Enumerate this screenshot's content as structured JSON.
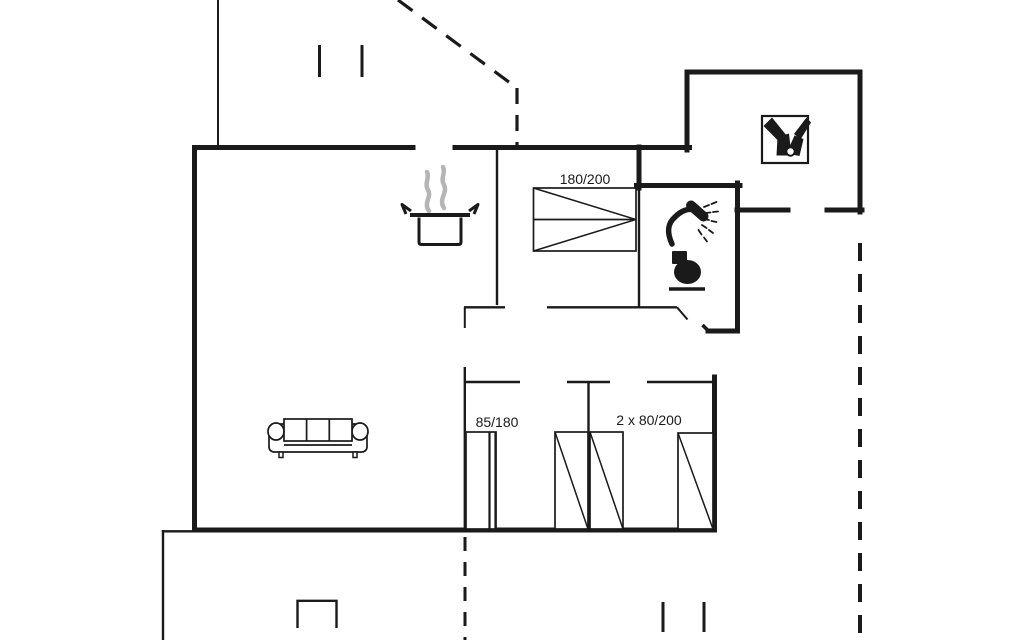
{
  "title": "Holiday home floor plan",
  "colors": {
    "line": "#1a1a1a",
    "steam": "#b5b5b5",
    "bg": "#ffffff"
  },
  "bed_labels": {
    "double": "180/200",
    "single": "85/180",
    "twin": "2 x 80/200"
  },
  "plan": {
    "width": 1024,
    "height": 640,
    "items": [
      {
        "type": "path",
        "name": "wall-west-south-east",
        "d": "M413,147.5 L194.5,147.5 L194.5,530 L714.5,530 L714.5,377",
        "w": 5,
        "cap": "square"
      },
      {
        "type": "path",
        "name": "wall-north-right",
        "d": "M455,147.5 L689.5,147.5",
        "w": 5,
        "cap": "square"
      },
      {
        "type": "path",
        "name": "annex-walls",
        "d": "M687,150 L687,72 L860,72 L860,212",
        "w": 5,
        "cap": "square"
      },
      {
        "type": "line",
        "name": "annex-south-wall-left",
        "x1": 737,
        "y1": 210,
        "x2": 788,
        "y2": 210,
        "w": 5,
        "cap": "square"
      },
      {
        "type": "line",
        "name": "annex-south-wall-right",
        "x1": 827,
        "y1": 210,
        "x2": 862,
        "y2": 210,
        "w": 5,
        "cap": "square"
      },
      {
        "type": "line",
        "name": "bathroom-north-wall",
        "x1": 636.5,
        "y1": 185.5,
        "x2": 740,
        "y2": 185.5,
        "w": 5,
        "cap": "square"
      },
      {
        "type": "line",
        "name": "bedroom-bathroom-wall-upper",
        "x1": 639,
        "y1": 147,
        "x2": 639,
        "y2": 188,
        "w": 5,
        "cap": "square"
      },
      {
        "type": "path",
        "name": "bathroom-east-wall-jog",
        "d": "M737.5,183 L737.5,331 L708,331",
        "w": 5,
        "cap": "square"
      },
      {
        "type": "line",
        "name": "bathroom-door-tick",
        "x1": 708,
        "y1": 330.5,
        "x2": 702.5,
        "y2": 325,
        "w": 3.5
      },
      {
        "type": "line",
        "name": "kitchen-bedroom-wall",
        "x1": 497,
        "y1": 150,
        "x2": 497,
        "y2": 305,
        "w": 2.4
      },
      {
        "type": "line",
        "name": "bathroom-west-wall-lower",
        "x1": 639,
        "y1": 188,
        "x2": 639,
        "y2": 307,
        "w": 2.4
      },
      {
        "type": "line",
        "name": "hall-north-wall-left",
        "x1": 464,
        "y1": 307.3,
        "x2": 505,
        "y2": 307.3,
        "w": 2.4
      },
      {
        "type": "line",
        "name": "hall-north-wall-right",
        "x1": 547,
        "y1": 307.3,
        "x2": 640,
        "y2": 307.3,
        "w": 2.4
      },
      {
        "type": "line",
        "name": "bedroom-door-leaf",
        "x1": 464.8,
        "y1": 307,
        "x2": 464.8,
        "y2": 328,
        "w": 2
      },
      {
        "type": "line",
        "name": "bathroom-south-wall",
        "x1": 640,
        "y1": 307.3,
        "x2": 677,
        "y2": 307.3,
        "w": 2.4
      },
      {
        "type": "line",
        "name": "bathroom-door-leaf",
        "x1": 677,
        "y1": 307.3,
        "x2": 687.5,
        "y2": 319.5,
        "w": 2
      },
      {
        "type": "line",
        "name": "hall-south-wall-left",
        "x1": 466,
        "y1": 382,
        "x2": 520,
        "y2": 382,
        "w": 2.4
      },
      {
        "type": "line",
        "name": "hall-south-wall-mid",
        "x1": 567,
        "y1": 382,
        "x2": 610,
        "y2": 382,
        "w": 2.4
      },
      {
        "type": "line",
        "name": "hall-south-wall-right",
        "x1": 647,
        "y1": 382,
        "x2": 714,
        "y2": 382,
        "w": 2.4
      },
      {
        "type": "line",
        "name": "small-rooms-partition",
        "x1": 588.5,
        "y1": 382,
        "x2": 588.5,
        "y2": 530,
        "w": 2.4
      },
      {
        "type": "line",
        "name": "small-room-west-wall",
        "x1": 464.8,
        "y1": 367,
        "x2": 464.8,
        "y2": 530,
        "w": 2.4
      },
      {
        "type": "line",
        "name": "terrace-west-edge",
        "x1": 163,
        "y1": 530,
        "x2": 163,
        "y2": 640,
        "w": 2.4
      },
      {
        "type": "line",
        "name": "terrace-north-edge",
        "x1": 161.8,
        "y1": 531.3,
        "x2": 194,
        "y2": 531.3,
        "w": 2.4
      },
      {
        "type": "path",
        "name": "terrace-window-mark",
        "d": "M297.5,628 L297.5,600.8 L336.5,600.8 L336.5,628",
        "w": 2.4
      },
      {
        "type": "line",
        "name": "carport-edge",
        "x1": 218,
        "y1": 0,
        "x2": 218,
        "y2": 147,
        "w": 2
      },
      {
        "type": "line",
        "name": "window-tick-top-1",
        "x1": 319.5,
        "y1": 45,
        "x2": 319.5,
        "y2": 77,
        "w": 3
      },
      {
        "type": "line",
        "name": "window-tick-top-2",
        "x1": 362,
        "y1": 45,
        "x2": 362,
        "y2": 77,
        "w": 3
      },
      {
        "type": "line",
        "name": "window-tick-bottom-1",
        "x1": 663,
        "y1": 602,
        "x2": 663,
        "y2": 632,
        "w": 3
      },
      {
        "type": "line",
        "name": "window-tick-bottom-2",
        "x1": 704,
        "y1": 602,
        "x2": 704,
        "y2": 632,
        "w": 3
      },
      {
        "type": "line",
        "name": "boundary-dashed-diagonal",
        "x1": 398,
        "y1": 0,
        "x2": 517,
        "y2": 88,
        "w": 3.2,
        "dash": "18,12"
      },
      {
        "type": "line",
        "name": "boundary-dashed-vertical-top",
        "x1": 517,
        "y1": 88,
        "x2": 517,
        "y2": 146,
        "w": 3.2,
        "dash": "16,11"
      },
      {
        "type": "line",
        "name": "boundary-dashed-east",
        "x1": 860,
        "y1": 243,
        "x2": 860,
        "y2": 640,
        "w": 4,
        "dash": "18,13"
      },
      {
        "type": "line",
        "name": "boundary-dashed-south",
        "x1": 465,
        "y1": 537,
        "x2": 465,
        "y2": 640,
        "w": 3,
        "dash": "14,11"
      },
      {
        "type": "rect",
        "name": "double-bed",
        "x": 533.5,
        "y": 188,
        "width": 102.5,
        "height": 63,
        "w": 1.7,
        "fill": "white"
      },
      {
        "type": "line",
        "name": "double-bed-mid-line",
        "x1": 533.5,
        "y1": 219.5,
        "x2": 636,
        "y2": 219.5,
        "w": 1.7
      },
      {
        "type": "line",
        "name": "double-bed-diagonal-1",
        "x1": 533.5,
        "y1": 188,
        "x2": 636,
        "y2": 219.5,
        "w": 1.5
      },
      {
        "type": "line",
        "name": "double-bed-diagonal-2",
        "x1": 533.5,
        "y1": 251,
        "x2": 636,
        "y2": 219.5,
        "w": 1.5
      },
      {
        "type": "rect",
        "name": "bed-85x180",
        "x": 466,
        "y": 432,
        "width": 30,
        "height": 97,
        "w": 1.7,
        "fill": "white"
      },
      {
        "type": "line",
        "name": "bed-85x180-edge-1",
        "x1": 489.5,
        "y1": 432,
        "x2": 489.5,
        "y2": 529,
        "w": 2.2
      },
      {
        "type": "line",
        "name": "bed-85x180-edge-2",
        "x1": 495.5,
        "y1": 432,
        "x2": 495.5,
        "y2": 529,
        "w": 2.2
      },
      {
        "type": "rect",
        "name": "bed-80x200-a",
        "x": 555,
        "y": 432,
        "width": 33,
        "height": 97,
        "w": 1.7,
        "fill": "white"
      },
      {
        "type": "line",
        "name": "bed-80x200-a-diagonal",
        "x1": 555,
        "y1": 432,
        "x2": 588,
        "y2": 529,
        "w": 1.5
      },
      {
        "type": "rect",
        "name": "bed-80x200-b",
        "x": 590,
        "y": 432,
        "width": 33,
        "height": 97,
        "w": 1.7,
        "fill": "white"
      },
      {
        "type": "line",
        "name": "bed-80x200-b-diagonal",
        "x1": 590,
        "y1": 432,
        "x2": 623,
        "y2": 529,
        "w": 1.5
      },
      {
        "type": "rect",
        "name": "bed-80x200-c",
        "x": 678,
        "y": 433,
        "width": 35,
        "height": 96,
        "w": 1.7,
        "fill": "white"
      },
      {
        "type": "line",
        "name": "bed-80x200-c-diagonal",
        "x1": 678,
        "y1": 433,
        "x2": 713,
        "y2": 529,
        "w": 1.5
      },
      {
        "type": "rect",
        "name": "sofa-body",
        "x": 269,
        "y": 424,
        "width": 98,
        "height": 28,
        "rx": 5,
        "w": 1.7,
        "fill": "white"
      },
      {
        "type": "ellipse",
        "name": "sofa-arm-left",
        "cx": 276,
        "cy": 431.5,
        "rx": 8,
        "ry": 8.5,
        "w": 1.7,
        "fill": "white"
      },
      {
        "type": "ellipse",
        "name": "sofa-arm-right",
        "cx": 360,
        "cy": 431.5,
        "rx": 8,
        "ry": 8.5,
        "w": 1.7,
        "fill": "white"
      },
      {
        "type": "rect",
        "name": "sofa-backrest",
        "x": 284,
        "y": 419,
        "width": 68,
        "height": 22,
        "w": 1.7,
        "fill": "white"
      },
      {
        "type": "line",
        "name": "sofa-cushion-divider-1",
        "x1": 306.6,
        "y1": 419,
        "x2": 306.6,
        "y2": 441,
        "w": 1.7
      },
      {
        "type": "line",
        "name": "sofa-cushion-divider-2",
        "x1": 329.3,
        "y1": 419,
        "x2": 329.3,
        "y2": 441,
        "w": 1.7
      },
      {
        "type": "line",
        "name": "sofa-seat-line",
        "x1": 284,
        "y1": 445,
        "x2": 352,
        "y2": 445,
        "w": 1.7
      },
      {
        "type": "rect",
        "name": "sofa-leg-left",
        "x": 279,
        "y": 452,
        "width": 4,
        "height": 5.5,
        "w": 1.5,
        "fill": "white"
      },
      {
        "type": "rect",
        "name": "sofa-leg-right",
        "x": 353,
        "y": 452,
        "width": 4,
        "height": 5.5,
        "w": 1.5,
        "fill": "white"
      },
      {
        "type": "path",
        "name": "steam-icon-1",
        "d": "M429,211 C423,203 432,197 428,190 C424,183 430,178 427,172",
        "w": 4.5,
        "stroke": "steam",
        "cap": "round"
      },
      {
        "type": "path",
        "name": "steam-icon-2",
        "d": "M444,208 C438,199 448,193 444,185 C440,178 446,173 443,167",
        "w": 4.5,
        "stroke": "steam",
        "cap": "round"
      },
      {
        "type": "path",
        "name": "cooking-pot-icon-body",
        "d": "M419,217.5 L419,242 Q419,244.5 421.5,244.5 L458.5,244.5 Q461,244.5 461,242 L461,217.5",
        "w": 3,
        "fill": "white"
      },
      {
        "type": "line",
        "name": "cooking-pot-icon-rim",
        "x1": 410,
        "y1": 215,
        "x2": 470,
        "y2": 215,
        "w": 4
      },
      {
        "type": "path",
        "name": "cooking-pot-icon-handle-left",
        "d": "M411,211 L402,204.5 L406,214",
        "w": 3,
        "join": "round"
      },
      {
        "type": "path",
        "name": "cooking-pot-icon-handle-right",
        "d": "M469,211 L478,204.5 L474,214",
        "w": 3,
        "join": "round"
      },
      {
        "type": "path",
        "name": "shower-icon-arm",
        "d": "M672,244 C667,233 667,224 675,217 C681,211 689,207 696,211",
        "w": 5.5,
        "cap": "round"
      },
      {
        "type": "line",
        "name": "shower-icon-head",
        "x1": 691,
        "y1": 205.5,
        "x2": 703.5,
        "y2": 216.5,
        "w": 10,
        "cap": "round"
      },
      {
        "type": "line",
        "name": "shower-icon-spray-1",
        "x1": 704,
        "y1": 207,
        "x2": 709,
        "y2": 205,
        "w": 1.8,
        "cap": "round"
      },
      {
        "type": "line",
        "name": "shower-icon-spray-2",
        "x1": 711.5,
        "y1": 204,
        "x2": 716.5,
        "y2": 202,
        "w": 1.8,
        "cap": "round"
      },
      {
        "type": "line",
        "name": "shower-icon-spray-3",
        "x1": 705,
        "y1": 213,
        "x2": 710.5,
        "y2": 212.5,
        "w": 1.8,
        "cap": "round"
      },
      {
        "type": "line",
        "name": "shower-icon-spray-4",
        "x1": 713,
        "y1": 212,
        "x2": 718,
        "y2": 211.5,
        "w": 1.8,
        "cap": "round"
      },
      {
        "type": "line",
        "name": "shower-icon-spray-5",
        "x1": 704,
        "y1": 219,
        "x2": 709,
        "y2": 220,
        "w": 1.8,
        "cap": "round"
      },
      {
        "type": "line",
        "name": "shower-icon-spray-6",
        "x1": 711.5,
        "y1": 221,
        "x2": 716.5,
        "y2": 222,
        "w": 1.8,
        "cap": "round"
      },
      {
        "type": "line",
        "name": "shower-icon-spray-7",
        "x1": 702,
        "y1": 225,
        "x2": 706.5,
        "y2": 228,
        "w": 1.8,
        "cap": "round"
      },
      {
        "type": "line",
        "name": "shower-icon-spray-8",
        "x1": 709,
        "y1": 230,
        "x2": 713,
        "y2": 233,
        "w": 1.8,
        "cap": "round"
      },
      {
        "type": "line",
        "name": "shower-icon-spray-9",
        "x1": 698.5,
        "y1": 230,
        "x2": 701.5,
        "y2": 234.5,
        "w": 1.8,
        "cap": "round"
      },
      {
        "type": "line",
        "name": "shower-icon-spray-10",
        "x1": 704,
        "y1": 237.5,
        "x2": 707,
        "y2": 241.5,
        "w": 1.8,
        "cap": "round"
      },
      {
        "type": "rect",
        "name": "toilet-icon-tank",
        "x": 672,
        "y": 251,
        "width": 15,
        "height": 13,
        "rx": 1,
        "fill": "line",
        "stroke": "none"
      },
      {
        "type": "ellipse",
        "name": "toilet-icon-bowl",
        "cx": 687.5,
        "cy": 272,
        "rx": 13.5,
        "ry": 12,
        "fill": "line",
        "stroke": "none"
      },
      {
        "type": "line",
        "name": "toilet-icon-base",
        "x1": 669,
        "y1": 289,
        "x2": 705,
        "y2": 289,
        "w": 3.5
      },
      {
        "type": "rect",
        "name": "boot-wash-icon-box",
        "x": 762,
        "y": 116,
        "width": 46,
        "height": 47,
        "w": 2.2,
        "fill": "white"
      },
      {
        "type": "path",
        "name": "boot-wash-icon-left-strap",
        "d": "M763.5,126 L772,117.5 L787,136 L780,142.5 Z",
        "fill": "line",
        "stroke": "none"
      },
      {
        "type": "path",
        "name": "boot-wash-icon-left-shaft",
        "d": "M777.5,137 L789,133.5 L791.5,155.5 L776.5,155.5 Z",
        "fill": "line",
        "stroke": "none"
      },
      {
        "type": "path",
        "name": "boot-wash-icon-right-strap",
        "d": "M806.5,117.5 L811,122.5 L800.5,139.5 L794,134 Z",
        "fill": "line",
        "stroke": "none"
      },
      {
        "type": "path",
        "name": "boot-wash-icon-right-shaft",
        "d": "M794.5,135.5 L803.5,139 L799.5,156 L786.5,153.5 Z",
        "fill": "line",
        "stroke": "none"
      },
      {
        "type": "circle",
        "name": "boot-wash-icon-drain",
        "cx": 790.5,
        "cy": 151.5,
        "r": 4.2,
        "w": 2,
        "fill": "white"
      },
      {
        "type": "text",
        "name": "label-double-bed",
        "x": 585,
        "y": 184,
        "size": 14,
        "bind": "bed_labels.double"
      },
      {
        "type": "text",
        "name": "label-single-bed",
        "x": 497,
        "y": 427,
        "size": 14,
        "bind": "bed_labels.single"
      },
      {
        "type": "text",
        "name": "label-twin-beds",
        "x": 649,
        "y": 425,
        "size": 14,
        "bind": "bed_labels.twin"
      }
    ]
  }
}
